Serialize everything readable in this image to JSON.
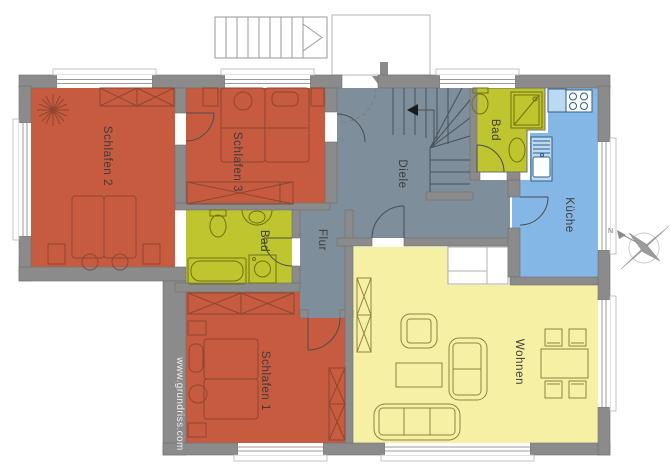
{
  "watermark": {
    "text": "www.grundriss.com"
  },
  "compass": {
    "north_label": "N"
  },
  "palette": {
    "wall": "#8B8B8B",
    "bedroom": "#C75B3F",
    "hallway": "#7E8E9B",
    "bathroom": "#BFC52E",
    "kitchen": "#85B7E6",
    "kitchen_counter": "#BCD9F2",
    "living": "#F5F0A3",
    "bedroom_stroke": "#8F4630",
    "bath_stroke": "#6F7211",
    "kitchen_stroke": "#2F5E86",
    "living_stroke": "#8D8440",
    "hall_stroke": "#47525B",
    "label_text": "#3D3D3D"
  },
  "rooms": [
    {
      "id": "schlafen-2",
      "label": "Schlafen 2",
      "type": "bedroom"
    },
    {
      "id": "schlafen-3",
      "label": "Schlafen 3",
      "type": "bedroom"
    },
    {
      "id": "diele",
      "label": "Diele",
      "type": "hallway"
    },
    {
      "id": "flur",
      "label": "Flur",
      "type": "hallway"
    },
    {
      "id": "bad-upper",
      "label": "Bad",
      "type": "bathroom"
    },
    {
      "id": "bad-lower",
      "label": "Bad",
      "type": "bathroom"
    },
    {
      "id": "kueche",
      "label": "Küche",
      "type": "kitchen"
    },
    {
      "id": "schlafen-1",
      "label": "Schlafen 1",
      "type": "bedroom"
    },
    {
      "id": "wohnen",
      "label": "Wohnen",
      "type": "living"
    }
  ]
}
